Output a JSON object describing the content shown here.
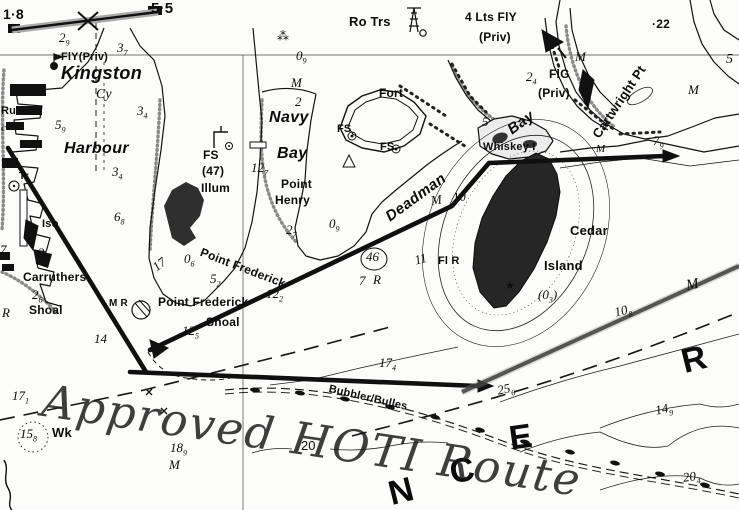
{
  "annotation": {
    "text": "Approved HOTI Route"
  },
  "colors": {
    "ink": "#111111",
    "pencil_route": "#1c1c1c",
    "stipple": "#8a8a8a",
    "island_fill": "#262626"
  },
  "symbols": {
    "light_star": "★",
    "rapids_mark": "⁂"
  },
  "labels": [
    {
      "name": "clearance-left",
      "text": "1·8",
      "x": 3,
      "y": 7,
      "cls": "pl",
      "fs": 14
    },
    {
      "name": "clearance-right",
      "text": "5·5",
      "x": 151,
      "y": 1,
      "cls": "pl",
      "fs": 15
    },
    {
      "name": "depth-2-9",
      "text": "2",
      "sub": "9",
      "x": 59,
      "y": 31,
      "cls": "d"
    },
    {
      "name": "depth-3-7",
      "text": "3",
      "sub": "7",
      "x": 117,
      "y": 41,
      "cls": "d"
    },
    {
      "name": "light-fly-priv",
      "text": "FlY(Priv)",
      "x": 61,
      "y": 52,
      "cls": "pl",
      "fs": 11
    },
    {
      "name": "place-kingston",
      "text": "Kingston",
      "x": 61,
      "y": 64,
      "cls": "wn",
      "fs": 18
    },
    {
      "name": "label-cy",
      "text": "Cy",
      "x": 96,
      "y": 88,
      "cls": "d",
      "fs": 14
    },
    {
      "name": "depth-3-4a",
      "text": "3",
      "sub": "4",
      "x": 137,
      "y": 104,
      "cls": "d"
    },
    {
      "name": "label-ru",
      "text": "Ru",
      "x": 1,
      "y": 106,
      "cls": "pl",
      "fs": 11
    },
    {
      "name": "label-c",
      "text": "c",
      "x": 1,
      "y": 123,
      "cls": "d",
      "fs": 11
    },
    {
      "name": "depth-5-9",
      "text": "5",
      "sub": "9",
      "x": 55,
      "y": 118,
      "cls": "d"
    },
    {
      "name": "place-harbour",
      "text": "Harbour",
      "x": 64,
      "y": 141,
      "cls": "wn",
      "fs": 16
    },
    {
      "name": "depth-3-4b",
      "text": "3",
      "sub": "4",
      "x": 112,
      "y": 165,
      "cls": "d"
    },
    {
      "name": "label-tr",
      "text": "Tr",
      "x": 19,
      "y": 172,
      "cls": "pl",
      "fs": 10
    },
    {
      "name": "depth-6-8",
      "text": "6",
      "sub": "8",
      "x": 114,
      "y": 210,
      "cls": "d"
    },
    {
      "name": "light-iso",
      "text": "Iso",
      "x": 42,
      "y": 219,
      "cls": "pl",
      "fs": 11
    },
    {
      "name": "station-fs47-line1",
      "text": "FS",
      "x": 203,
      "y": 149,
      "cls": "pl",
      "fs": 12
    },
    {
      "name": "station-fs47-line2",
      "text": "(47)",
      "x": 202,
      "y": 165,
      "cls": "pl",
      "fs": 12
    },
    {
      "name": "station-fs47-line3",
      "text": "Illum",
      "x": 201,
      "y": 182,
      "cls": "pl",
      "fs": 12
    },
    {
      "name": "depth-0-6",
      "text": "0",
      "sub": "6",
      "x": 184,
      "y": 252,
      "cls": "d"
    },
    {
      "name": "depth-17-shore",
      "text": "17",
      "x": 150,
      "y": 263,
      "cls": "d",
      "rot": -38
    },
    {
      "name": "depth-5-2",
      "text": "5",
      "sub": "2",
      "x": 210,
      "y": 272,
      "cls": "d"
    },
    {
      "name": "depth-3-5",
      "text": "3",
      "sub": "5",
      "x": 38,
      "y": 246,
      "cls": "d"
    },
    {
      "name": "depth-7-left",
      "text": "7",
      "x": 0,
      "y": 243,
      "cls": "d"
    },
    {
      "name": "place-carruthers",
      "text": "Carruthers",
      "x": 23,
      "y": 271,
      "cls": "pl",
      "fs": 12
    },
    {
      "name": "depth-2-6",
      "text": "2",
      "sub": "6",
      "x": 32,
      "y": 288,
      "cls": "d"
    },
    {
      "name": "place-carruthers-shoal",
      "text": "Shoal",
      "x": 29,
      "y": 304,
      "cls": "pl",
      "fs": 12
    },
    {
      "name": "depth-r-left",
      "text": "R",
      "x": 2,
      "y": 306,
      "cls": "d"
    },
    {
      "name": "depth-17-1",
      "text": "17",
      "sub": "1",
      "x": 12,
      "y": 389,
      "cls": "d"
    },
    {
      "name": "wreck-depth-15-8",
      "text": "15",
      "sub": "8",
      "x": 20,
      "y": 427,
      "cls": "d"
    },
    {
      "name": "wreck-label",
      "text": "Wk",
      "x": 52,
      "y": 426,
      "cls": "pl",
      "fs": 13
    },
    {
      "name": "depth-14",
      "text": "14",
      "x": 94,
      "y": 332,
      "cls": "d"
    },
    {
      "name": "buoy-label-mr",
      "text": "M R",
      "x": 109,
      "y": 299,
      "cls": "pl",
      "fs": 10
    },
    {
      "name": "place-pf-shoal-line1",
      "text": "Point Frederick",
      "x": 158,
      "y": 296,
      "cls": "pl",
      "fs": 12
    },
    {
      "name": "place-pf-shoal-line2",
      "text": "Shoal",
      "x": 206,
      "y": 316,
      "cls": "pl",
      "fs": 12
    },
    {
      "name": "depth-12-2",
      "text": "12",
      "sub": "2",
      "x": 266,
      "y": 287,
      "cls": "d"
    },
    {
      "name": "depth-12-5",
      "text": "12",
      "sub": "5",
      "x": 182,
      "y": 324,
      "cls": "d"
    },
    {
      "name": "place-point-frederick",
      "text": "Point Frederick",
      "x": 203,
      "y": 246,
      "cls": "pl",
      "fs": 12,
      "rot": 21
    },
    {
      "name": "depth-12-7",
      "text": "12",
      "sub": "7",
      "x": 251,
      "y": 161,
      "cls": "d"
    },
    {
      "name": "place-navy",
      "text": "Navy",
      "x": 269,
      "y": 110,
      "cls": "wn",
      "fs": 16
    },
    {
      "name": "place-navy-bay",
      "text": "Bay",
      "x": 277,
      "y": 146,
      "cls": "wn",
      "fs": 16
    },
    {
      "name": "depth-m-navy",
      "text": "M",
      "x": 291,
      "y": 76,
      "cls": "d"
    },
    {
      "name": "depth-2-navy",
      "text": "2",
      "x": 295,
      "y": 95,
      "cls": "d"
    },
    {
      "name": "depth-0-9a",
      "text": "0",
      "sub": "9",
      "x": 296,
      "y": 49,
      "cls": "d"
    },
    {
      "name": "rapids-symbol",
      "text": "⁂",
      "x": 277,
      "y": 30,
      "cls": "sym",
      "fs": 12
    },
    {
      "name": "place-point-henry-line1",
      "text": "Point",
      "x": 281,
      "y": 178,
      "cls": "pl",
      "fs": 12
    },
    {
      "name": "place-point-henry-line2",
      "text": "Henry",
      "x": 275,
      "y": 194,
      "cls": "pl",
      "fs": 12
    },
    {
      "name": "depth-2-7",
      "text": "2",
      "sub": "7",
      "x": 286,
      "y": 223,
      "cls": "d"
    },
    {
      "name": "depth-0-9b",
      "text": "0",
      "sub": "9",
      "x": 329,
      "y": 217,
      "cls": "d"
    },
    {
      "name": "place-fort",
      "text": "Fort",
      "x": 379,
      "y": 87,
      "cls": "pl",
      "fs": 12
    },
    {
      "name": "station-fs-a",
      "text": "FS",
      "x": 337,
      "y": 124,
      "cls": "pl",
      "fs": 11
    },
    {
      "name": "station-fs-b",
      "text": "FS",
      "x": 380,
      "y": 142,
      "cls": "pl",
      "fs": 11
    },
    {
      "name": "station-ro-trs",
      "text": "Ro Trs",
      "x": 349,
      "y": 15,
      "cls": "pl",
      "fs": 13
    },
    {
      "name": "light-4lts-line1",
      "text": "4 Lts FlY",
      "x": 465,
      "y": 11,
      "cls": "pl",
      "fs": 12
    },
    {
      "name": "light-4lts-line2",
      "text": "(Priv)",
      "x": 479,
      "y": 31,
      "cls": "pl",
      "fs": 12
    },
    {
      "name": "spot-height-22",
      "text": "·22",
      "x": 652,
      "y": 18,
      "cls": "pl",
      "fs": 12
    },
    {
      "name": "depth-m-cartwright",
      "text": "M",
      "x": 575,
      "y": 50,
      "cls": "d"
    },
    {
      "name": "depth-2-4",
      "text": "2",
      "sub": "4",
      "x": 526,
      "y": 70,
      "cls": "d"
    },
    {
      "name": "light-flg",
      "text": "FlG",
      "x": 549,
      "y": 68,
      "cls": "pl",
      "fs": 12
    },
    {
      "name": "light-flg-priv",
      "text": "(Priv)",
      "x": 538,
      "y": 87,
      "cls": "pl",
      "fs": 12
    },
    {
      "name": "place-cartwright-pt",
      "text": "Cartwright Pt",
      "x": 590,
      "y": 133,
      "cls": "pl",
      "fs": 13,
      "rot": -56
    },
    {
      "name": "depth-5-right",
      "text": "5",
      "x": 726,
      "y": 53,
      "cls": "d",
      "fs": 14
    },
    {
      "name": "depth-m-right-top",
      "text": "M",
      "x": 688,
      "y": 83,
      "cls": "d"
    },
    {
      "name": "place-deadman",
      "text": "Deadman",
      "x": 383,
      "y": 212,
      "cls": "wn",
      "fs": 15,
      "rot": -36
    },
    {
      "name": "place-deadman-bay",
      "text": "Bay",
      "x": 505,
      "y": 125,
      "cls": "wn",
      "fs": 15,
      "rot": -36
    },
    {
      "name": "depth-5-bay",
      "text": "5",
      "x": 482,
      "y": 115,
      "cls": "d",
      "fs": 13
    },
    {
      "name": "place-whiskey-i",
      "text": "Whiskey I",
      "x": 483,
      "y": 142,
      "cls": "pl",
      "fs": 11
    },
    {
      "name": "depth-m-whiskey",
      "text": "M",
      "x": 596,
      "y": 144,
      "cls": "d",
      "fs": 11
    },
    {
      "name": "depth-7-9",
      "text": "7",
      "sub": "9",
      "x": 653,
      "y": 134,
      "cls": "d"
    },
    {
      "name": "depth-m10-m",
      "text": "M",
      "x": 430,
      "y": 194,
      "cls": "d",
      "rot": -8
    },
    {
      "name": "depth-m10-10",
      "text": "10",
      "x": 452,
      "y": 191,
      "cls": "d",
      "rot": -8
    },
    {
      "name": "depth-11",
      "text": "11",
      "x": 413,
      "y": 254,
      "cls": "d",
      "rot": -15
    },
    {
      "name": "light-fl-r",
      "text": "Fl R",
      "x": 438,
      "y": 256,
      "cls": "pl",
      "fs": 11
    },
    {
      "name": "light-star",
      "text": "★",
      "x": 505,
      "y": 280,
      "cls": "sym",
      "fs": 11
    },
    {
      "name": "depth-46",
      "text": "46",
      "x": 366,
      "y": 250,
      "cls": "d"
    },
    {
      "name": "depth-46-7",
      "text": "7",
      "x": 359,
      "y": 274,
      "cls": "d"
    },
    {
      "name": "depth-46-r",
      "text": "R",
      "x": 373,
      "y": 273,
      "cls": "d"
    },
    {
      "name": "place-cedar",
      "text": "Cedar",
      "x": 570,
      "y": 224,
      "cls": "pl",
      "fs": 13
    },
    {
      "name": "place-cedar-island",
      "text": "Island",
      "x": 544,
      "y": 259,
      "cls": "pl",
      "fs": 13
    },
    {
      "name": "depth-0-3",
      "text": "(0",
      "sub": "3",
      "tail": ")",
      "x": 538,
      "y": 288,
      "cls": "d"
    },
    {
      "name": "depth-10-8",
      "text": "10",
      "sub": "8",
      "x": 613,
      "y": 306,
      "cls": "d",
      "rot": -14
    },
    {
      "name": "depth-m-cedar-se",
      "text": "M",
      "x": 685,
      "y": 279,
      "cls": "d",
      "fs": 15,
      "rot": -10
    },
    {
      "name": "depth-17-4",
      "text": "17",
      "sub": "4",
      "x": 379,
      "y": 356,
      "cls": "d"
    },
    {
      "name": "depth-25-6",
      "text": "25",
      "sub": "6",
      "x": 496,
      "y": 384,
      "cls": "d",
      "rot": -12
    },
    {
      "name": "depth-14-9",
      "text": "14",
      "sub": "9",
      "x": 654,
      "y": 404,
      "cls": "d",
      "rot": -12
    },
    {
      "name": "depth-20-4",
      "text": "20",
      "sub": "4",
      "x": 682,
      "y": 471,
      "cls": "d",
      "rot": -8
    },
    {
      "name": "depth-18-9",
      "text": "18",
      "sub": "9",
      "x": 170,
      "y": 441,
      "cls": "d"
    },
    {
      "name": "depth-m-18",
      "text": "M",
      "x": 169,
      "y": 458,
      "cls": "d"
    },
    {
      "name": "contour-20",
      "text": "20",
      "x": 301,
      "y": 439,
      "cls": "d2",
      "fs": 13
    },
    {
      "name": "cable-bubbler-bulles",
      "text": "Bubbler/Bulles",
      "x": 330,
      "y": 384,
      "cls": "pl",
      "fs": 11,
      "rot": 13
    },
    {
      "name": "river-letter-n",
      "text": "N",
      "x": 385,
      "y": 478,
      "cls": "big",
      "rot": -14
    },
    {
      "name": "river-letter-c",
      "text": "C",
      "x": 447,
      "y": 456,
      "cls": "big",
      "rot": -10
    },
    {
      "name": "river-letter-e",
      "text": "E",
      "x": 507,
      "y": 422,
      "cls": "big",
      "rot": -8
    },
    {
      "name": "river-letter-r",
      "text": "R",
      "x": 678,
      "y": 346,
      "cls": "big",
      "rot": -14
    }
  ]
}
